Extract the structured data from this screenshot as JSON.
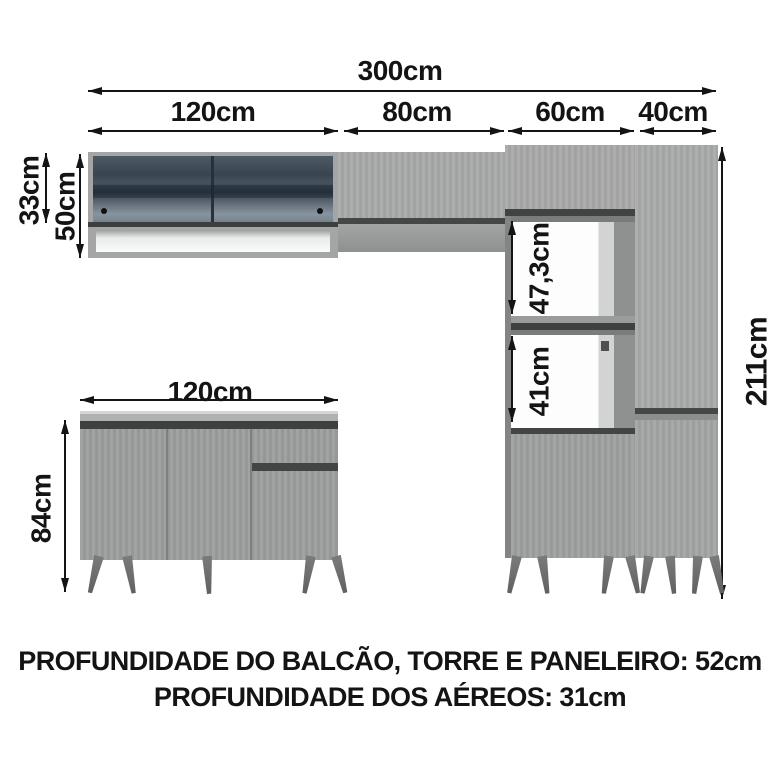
{
  "diagram": {
    "top_dims": {
      "total": "300cm",
      "sections": [
        "120cm",
        "80cm",
        "60cm",
        "40cm"
      ]
    },
    "left_dims": {
      "glass_height": "33cm",
      "cabinet_height": "50cm"
    },
    "tower_dims": {
      "upper_niche": "47,3cm",
      "lower_niche": "41cm"
    },
    "right_dims": {
      "total_height": "211cm"
    },
    "counter_dims": {
      "width": "120cm",
      "height": "84cm"
    },
    "footer": {
      "line1": "PROFUNDIDADE DO BALCÃO, TORRE E PANELEIRO: 52cm",
      "line2": "PROFUNDIDADE DOS AÉREOS: 31cm"
    },
    "colors": {
      "cabinet_gray": "#a4a5a5",
      "dark_gap": "#424343",
      "glass_dark": "#3d4854",
      "niche_white": "#fdfdfd",
      "legs_gray": "#6e6f70",
      "text": "#141414",
      "background": "#ffffff"
    }
  }
}
